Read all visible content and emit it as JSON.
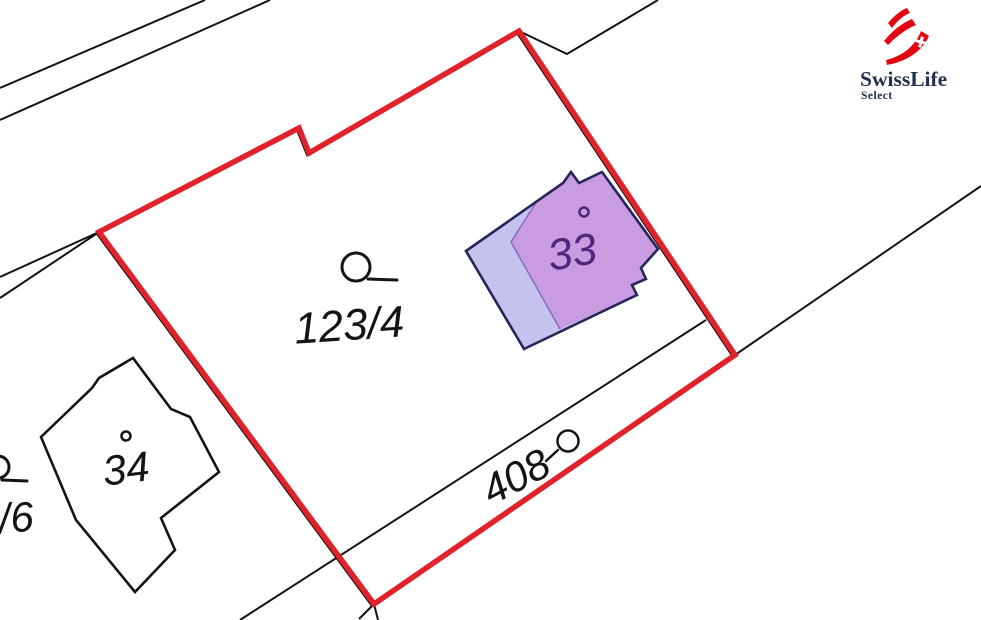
{
  "map": {
    "labels": {
      "parcel_main": "123/4",
      "parcel_road": "408",
      "building_33": "33",
      "building_34": "34",
      "parcel_partial": "/6"
    },
    "colors": {
      "boundary": "#e2222a",
      "footprint_light": "#c5c3ee",
      "building_purple": "#c99ce2",
      "building_outline": "#26265a",
      "building_label": "#50267d",
      "lines": "#141414"
    }
  },
  "logo": {
    "brand": "SwissLife",
    "product": "Select",
    "swoosh_color": "#e30613",
    "text_color": "#223050"
  }
}
